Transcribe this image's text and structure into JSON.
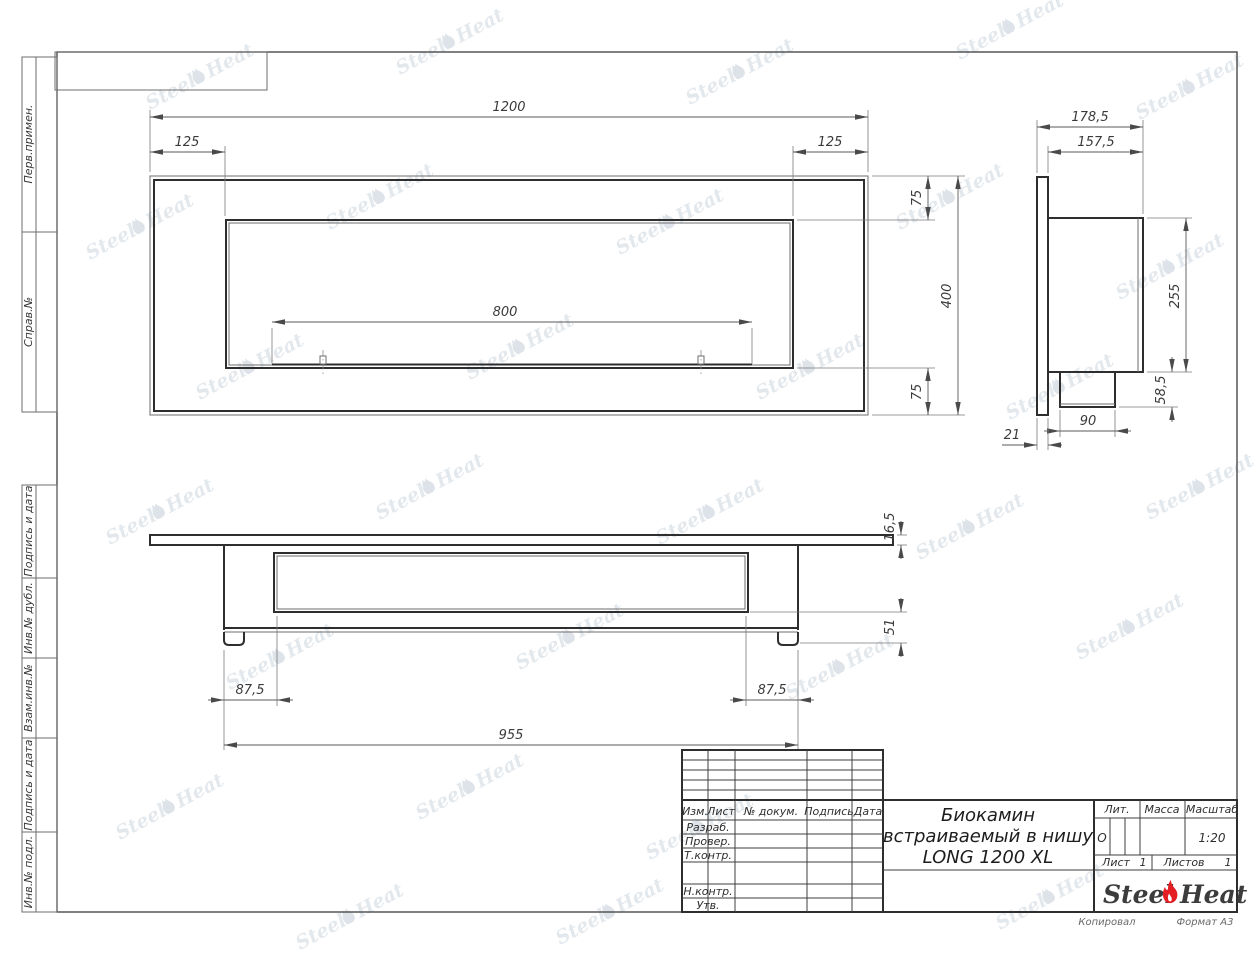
{
  "drawing_title": {
    "line1": "Биокамин",
    "line2": "встраиваемый в нишу",
    "line3": "LONG 1200 XL"
  },
  "dims": {
    "front": {
      "total_width": "1200",
      "inset_left": "125",
      "inset_right": "125",
      "burner_length": "800",
      "top_inset": "75",
      "total_height": "400",
      "bottom_inset": "75"
    },
    "side": {
      "total_depth": "178,5",
      "body_depth": "157,5",
      "body_height": "255",
      "box_height": "58,5",
      "box_width": "90",
      "flange_thickness": "21"
    },
    "top": {
      "flange_thickness": "16,5",
      "base_height": "51",
      "inset_left": "87,5",
      "inset_right": "87,5",
      "body_width": "955"
    }
  },
  "margin_labels": {
    "perv_primen": "Перв.примен.",
    "sprav_no": "Справ.№",
    "podpis_data_1": "Подпись и дата",
    "inv_dubl": "Инв.№ дубл.",
    "vzam_inv": "Взам.инв.№",
    "podpis_data_2": "Подпись и дата",
    "inv_podl": "Инв.№ подл."
  },
  "title_block": {
    "col_izm": "Изм.",
    "col_list": "Лист",
    "col_doc": "№ докум.",
    "col_sign": "Подпись",
    "col_date": "Дата",
    "row_razrab": "Разраб.",
    "row_prover": "Провер.",
    "row_tkontr": "Т.контр.",
    "row_nkontr": "Н.контр.",
    "row_utv": "Утв.",
    "lit_label": "Лит.",
    "mass_label": "Масса",
    "scale_label": "Масштаб",
    "lit_value": "О",
    "scale_value": "1:20",
    "sheet_label": "Лист",
    "sheet_value": "1",
    "sheets_label": "Листов",
    "sheets_value": "1",
    "copied_label": "Копировал",
    "format_label": "Формат А3"
  },
  "logo": {
    "steel": "Steel",
    "heat": "Heat"
  },
  "watermark": {
    "steel": "Steel",
    "heat": "Heat"
  },
  "colors": {
    "flame_red": "#e31e24",
    "line": "#3a3a3a",
    "watermark": "#ccd5de"
  }
}
